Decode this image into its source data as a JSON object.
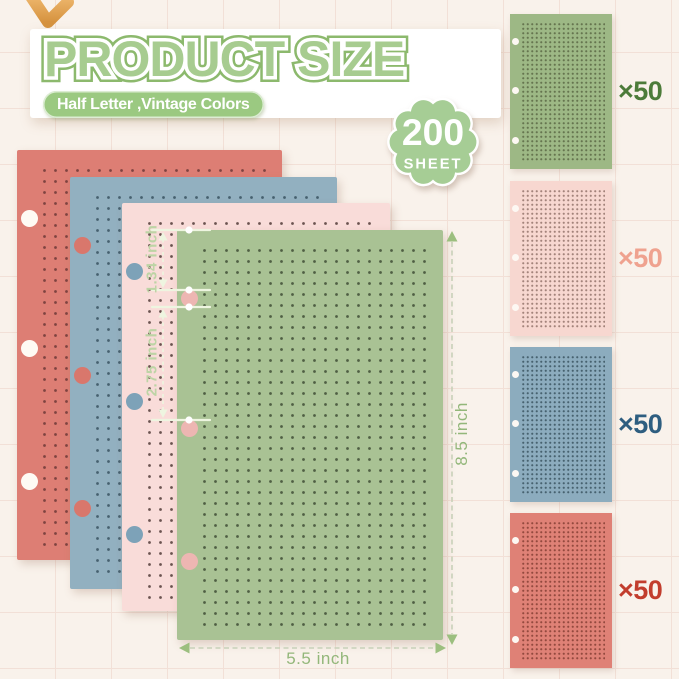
{
  "header": {
    "title": "PRODUCT SIZE",
    "subtitle": "Half Letter ,Vintage Colors",
    "badge_count": "200",
    "badge_unit": "SHEET"
  },
  "measurements": {
    "hole_offset": "1.34 inch",
    "hole_spacing": "2.75 inch",
    "sheet_height": "8.5 inch",
    "sheet_width": "5.5 inch"
  },
  "stack_sheets": [
    {
      "name": "coral-red",
      "color": "#dd7e74",
      "dot_color": "#7e4340",
      "hole_color": "#fefaf4"
    },
    {
      "name": "dusty-blue",
      "color": "#92b0c0",
      "dot_color": "#46606f",
      "hole_color": "#d9776c"
    },
    {
      "name": "blush-pink",
      "color": "#f9dcd9",
      "dot_color": "#6b5350",
      "hole_color": "#7da2b8"
    },
    {
      "name": "sage-green",
      "color": "#a9c294",
      "dot_color": "#4f5f43",
      "hole_color": "#edb6b2"
    }
  ],
  "swatches": [
    {
      "name": "green",
      "label": "×50",
      "color": "#9db885",
      "dot_color": "#65754f",
      "label_color": "#4c7b39",
      "hole_color": "#fdf8f3"
    },
    {
      "name": "pink",
      "label": "×50",
      "color": "#f7d7d0",
      "dot_color": "#a3837b",
      "label_color": "#efa28f",
      "hole_color": "#fdf8f3"
    },
    {
      "name": "blue",
      "label": "×50",
      "color": "#8cacbe",
      "dot_color": "#47626f",
      "label_color": "#2e5e80",
      "hole_color": "#fdf8f3"
    },
    {
      "name": "red",
      "label": "×50",
      "color": "#df8176",
      "dot_color": "#93493f",
      "label_color": "#c23d2d",
      "hole_color": "#fdf8f3"
    }
  ],
  "accent_colors": {
    "title_green": "#a7cc90",
    "badge_green": "#a6cd95",
    "pill_green": "#9bc981",
    "annotation_pale": "#eef5e0",
    "annotation_green": "#93b77a",
    "pencil_tan": "#e9ab62"
  },
  "icons": {
    "pencil": "pencil-tip-decoration"
  }
}
